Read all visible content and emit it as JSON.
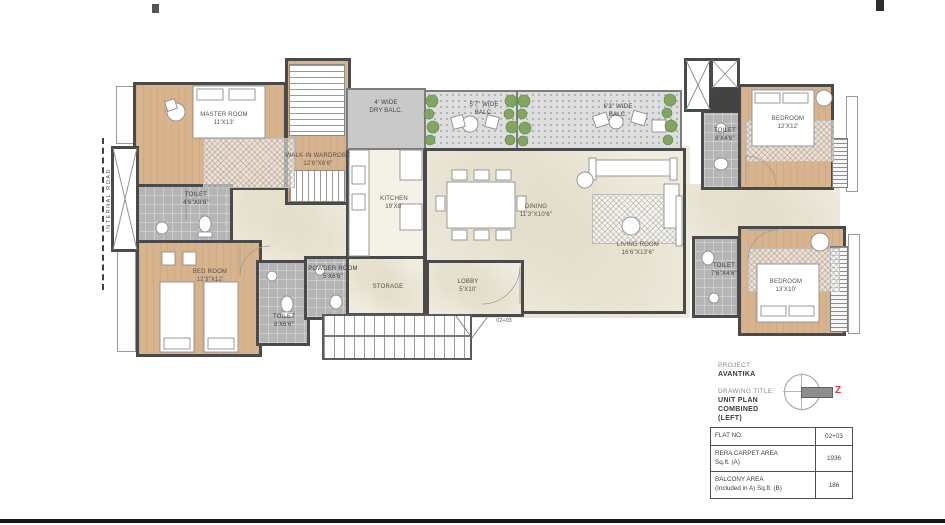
{
  "site": {
    "internal_road": "INTERNAL ROAD"
  },
  "rooms": {
    "master": {
      "name": "MASTER ROOM",
      "dim": "11'X13'"
    },
    "wardrobe": {
      "name": "WALK-IN WARDROBE",
      "dim": "12'6\"X6'6\""
    },
    "toilet_master": {
      "name": "TOILET",
      "dim": "4'6\"X8'6\""
    },
    "bedroom2": {
      "name": "BED ROOM",
      "dim": "12'3\"X12'"
    },
    "toilet2": {
      "name": "TOILET",
      "dim": "8'X6'6\""
    },
    "powder": {
      "name": "POWDER ROOM",
      "dim": "5'X6'6\""
    },
    "kitchen": {
      "name": "KITCHEN",
      "dim": "19'X8'"
    },
    "dry_balcony": {
      "name": "4' WIDE",
      "dim": "DRY BALC."
    },
    "balcony1": {
      "name": "5'7\" WIDE",
      "dim": "BALC."
    },
    "balcony2": {
      "name": "6'3\" WIDE",
      "dim": "BALC."
    },
    "dining": {
      "name": "DINING",
      "dim": "11'3\"X10'6\""
    },
    "living": {
      "name": "LIVING ROOM",
      "dim": "16'6\"X13'6\""
    },
    "storage": {
      "name": "STORAGE",
      "dim": ""
    },
    "lobby": {
      "name": "LOBBY",
      "dim": "5'X10'"
    },
    "bedroom3": {
      "name": "BEDROOM",
      "dim": "12'X12'"
    },
    "toilet3": {
      "name": "TOILET",
      "dim": "8'X4'6\""
    },
    "bedroom4": {
      "name": "BEDROOM",
      "dim": "13'X10'"
    },
    "toilet4": {
      "name": "TOILET",
      "dim": "7'6\"X4'6\""
    }
  },
  "entry": {
    "flat_marker": "02+03"
  },
  "title_block": {
    "project_label": "PROJECT:",
    "project_name": "AVANTIKA",
    "drawing_title_label": "DRAWING TITLE:",
    "drawing_title_line1": "UNIT PLAN",
    "drawing_title_line2": "COMBINED",
    "drawing_title_line3": "(LEFT)",
    "north_letter": "Z"
  },
  "info_table": {
    "rows": [
      {
        "label_line1": "FLAT NO.",
        "label_line2": "",
        "value": "02+03"
      },
      {
        "label_line1": "RERA CARPET AREA",
        "label_line2": "Sq.ft. (A)",
        "value": "1936"
      },
      {
        "label_line1": "BALCONY AREA",
        "label_line2": "(Included in A) Sq.ft. (B)",
        "value": "186"
      }
    ]
  },
  "colors": {
    "wall": "#4a4a4a",
    "wood_floor": "#d8b48e",
    "marble_floor": "#f0ecdf",
    "toilet_floor": "#b5b5b5",
    "plant_green": "#7ba45b",
    "north_red": "#c63b33"
  }
}
